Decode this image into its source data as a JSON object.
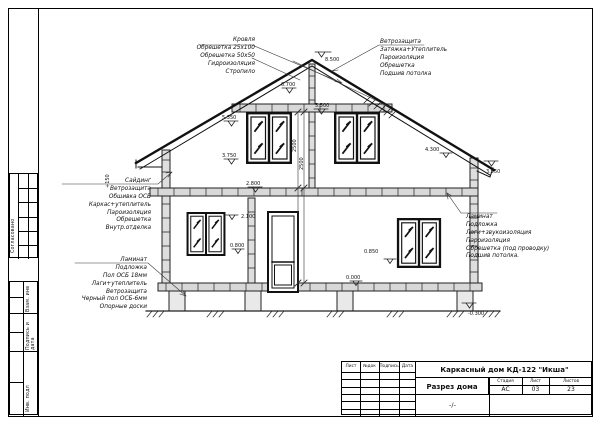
{
  "side_panel": {
    "approved": "Согласовано",
    "vzam": "Взам. инв",
    "podp": "Подпись и дата",
    "inv": "Инв. подл"
  },
  "title_block": {
    "project": "Каркасный дом КД-122 \"Икша\"",
    "drawing_title": "Разрез дома",
    "scale": "-/-",
    "col_sheet": "Лист",
    "col_doc": "№док",
    "col_sign": "Подпись",
    "col_date": "Дата",
    "stage_label": "Стадия",
    "sheet_label": "Лист",
    "sheets_label": "Листов",
    "stage": "АС",
    "sheet_no": "03",
    "sheets_total": "23"
  },
  "annotations": {
    "roof_left": [
      "Кровля",
      "Обрешетка 25х100",
      "Обрешетка 50х50",
      "Гидроизоляция",
      "Стропило"
    ],
    "roof_right": [
      "Ветрозащита",
      "Затяжка+Утеплитель",
      "Пароизоляция",
      "Обрешетка",
      "Подшив потолка"
    ],
    "wall_left": [
      "Сайдинг",
      "Ветрозащита",
      "Обшивка ОСБ",
      "Каркас+утеплитель",
      "Пароизоляция",
      "Обрешетка",
      "Внутр.отделка"
    ],
    "floor_left": [
      "Ламинат",
      "Подложка",
      "Пол ОСБ 18мм",
      "Лаги+утеплитель",
      "Ветрозащита",
      "Черный пол ОСБ-6мм",
      "Опорные доски"
    ],
    "ceiling_right": [
      "Ламинат",
      "Подложка",
      "Лаги+звукоизоляция",
      "Пароизоляция",
      "Обрешетка (под проводку)",
      "Подшив потолка."
    ]
  },
  "elevations": {
    "ridge": "8.500",
    "upper": "6.700",
    "ceiling2": "5.500",
    "win2_top": "5.350",
    "win2_sill": "3.750",
    "ceiling1": "2.800",
    "win1_top": "2.100",
    "win1_sill": "0.800",
    "right_sill": "0.850",
    "floor": "0.000",
    "ground": "-0.300",
    "eave_right": "4.300",
    "soffit_right": "3.950"
  },
  "dimensions": {
    "story_upper": "2500",
    "story_lower": "2500",
    "overhang": "+150"
  }
}
